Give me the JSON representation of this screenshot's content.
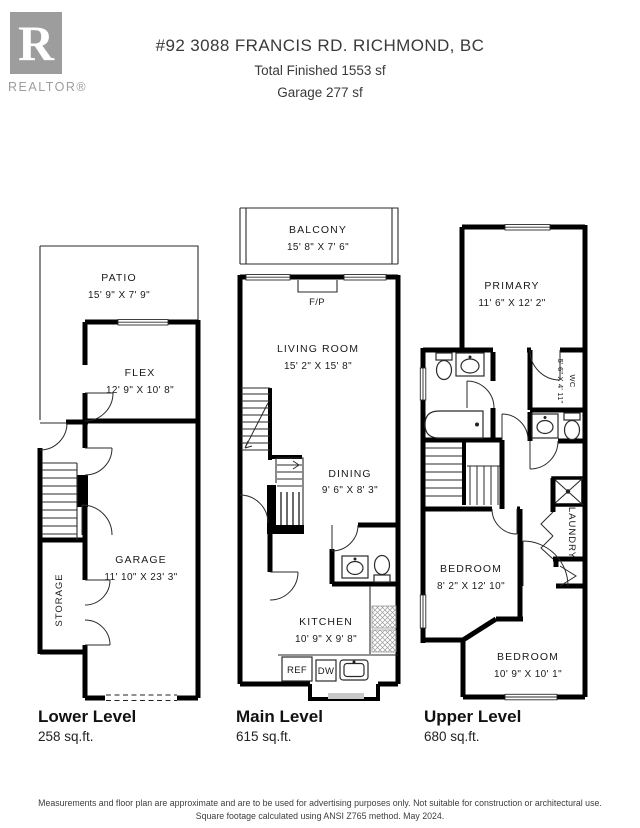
{
  "header": {
    "brand": {
      "letter": "R",
      "word": "REALTOR®"
    },
    "address": "#92 3088 FRANCIS RD. RICHMOND, BC",
    "total_line": "Total Finished  1553 sf",
    "garage_line": "Garage  277 sf"
  },
  "levels": {
    "lower": {
      "title": "Lower Level",
      "area": "258 sq.ft."
    },
    "main": {
      "title": "Main Level",
      "area": "615 sq.ft."
    },
    "upper": {
      "title": "Upper Level",
      "area": "680 sq.ft."
    }
  },
  "rooms": {
    "patio": {
      "name": "PATIO",
      "dims": "15' 9\" X 7' 9\""
    },
    "flex": {
      "name": "FLEX",
      "dims": "12' 9\" X 10' 8\""
    },
    "garage": {
      "name": "GARAGE",
      "dims": "11' 10\" X 23' 3\""
    },
    "storage": {
      "name": "STORAGE"
    },
    "balcony": {
      "name": "BALCONY",
      "dims": "15' 8\" X 7' 6\""
    },
    "fireplace": {
      "name": "F/P"
    },
    "living": {
      "name": "LIVING ROOM",
      "dims": "15' 2\" X 15' 8\""
    },
    "dining": {
      "name": "DINING",
      "dims": "9' 6\" X 8' 3\""
    },
    "kitchen": {
      "name": "KITCHEN",
      "dims": "10' 9\" X 9' 8\""
    },
    "ref": {
      "name": "REF"
    },
    "dw": {
      "name": "DW"
    },
    "primary": {
      "name": "PRIMARY",
      "dims": "11' 6\" X 12' 2\""
    },
    "wc": {
      "name": "WC",
      "dims": "5' 6\" X 4' 11\""
    },
    "laundry": {
      "name": "LAUNDRY"
    },
    "bedroom1": {
      "name": "BEDROOM",
      "dims": "8' 2\" X 12' 10\""
    },
    "bedroom2": {
      "name": "BEDROOM",
      "dims": "10' 9\" X 10' 1\""
    }
  },
  "footer": {
    "line1": "Measurements and floor plan are approximate and are to be used for advertising purposes only. Not suitable for construction or architectural use.",
    "line2": "Square footage calculated using ANSI Z765 method. May 2024."
  }
}
